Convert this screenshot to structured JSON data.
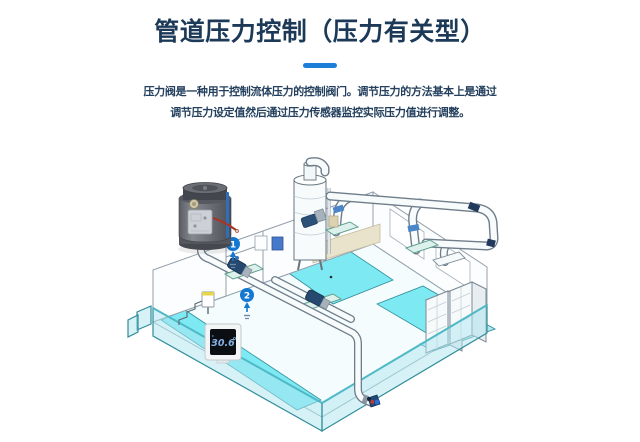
{
  "header": {
    "title": "管道压力控制（压力有关型）"
  },
  "description": {
    "line1": "压力阀是一种用于控制流体压力的控制阀门。调节压力的方法基本上是通过",
    "line2": "调节压力设定值然后通过压力传感器监控实际压力值进行调整。"
  },
  "illustration": {
    "markers": [
      {
        "label": "1"
      },
      {
        "label": "2"
      }
    ],
    "display": {
      "value": "30.6"
    },
    "colors": {
      "accent_blue": "#1e7fd8",
      "marker_blue": "#1478d2",
      "water_cyan": "#7de9f3",
      "glass_teal": "#2f8d99",
      "title_navy": "#1c3a57"
    }
  }
}
